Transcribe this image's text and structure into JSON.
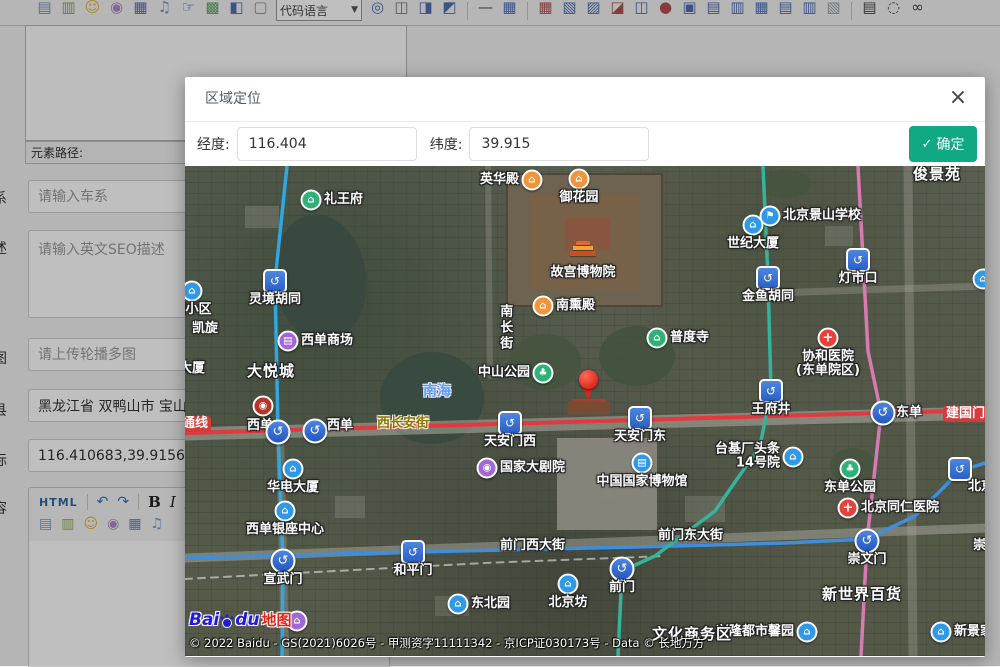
{
  "toolbar": {
    "dropdown_label": "代码语言",
    "icons": [
      {
        "name": "image-icon",
        "glyph": "▤",
        "color": "#6f94c4"
      },
      {
        "name": "multi-image-icon",
        "glyph": "▥",
        "color": "#87a35f"
      },
      {
        "name": "emoticon-icon",
        "glyph": "☺",
        "color": "#e2b437"
      },
      {
        "name": "palette-icon",
        "glyph": "◉",
        "color": "#b089c9"
      },
      {
        "name": "video-icon",
        "glyph": "▦",
        "color": "#4f6fb5"
      },
      {
        "name": "music-icon",
        "glyph": "♫",
        "color": "#6f9ad0"
      },
      {
        "name": "link-hand-icon",
        "glyph": "☞",
        "color": "#4f6fb5"
      },
      {
        "name": "map-icon",
        "glyph": "▩",
        "color": "#5fa05f"
      },
      {
        "name": "flash-icon",
        "glyph": "◧",
        "color": "#4f6fb5"
      },
      {
        "name": "page-icon",
        "glyph": "▢",
        "color": "#8a8a8a"
      },
      {
        "name": "globe-icon",
        "glyph": "◎",
        "color": "#4f6fb5"
      },
      {
        "name": "anchor-icon",
        "glyph": "◫",
        "color": "#777777"
      },
      {
        "name": "columns-icon",
        "glyph": "◨",
        "color": "#4f6fb5"
      },
      {
        "name": "layout-icon",
        "glyph": "◩",
        "color": "#4f6fb5"
      },
      {
        "name": "hr-icon",
        "glyph": "—",
        "color": "#555555"
      },
      {
        "name": "table-icon",
        "glyph": "▦",
        "color": "#4f6fb5"
      },
      {
        "name": "table-delete-icon",
        "glyph": "▦",
        "color": "#b05050"
      },
      {
        "name": "table-left-icon",
        "glyph": "▧",
        "color": "#4f6fb5"
      },
      {
        "name": "table-bottom-icon",
        "glyph": "▨",
        "color": "#4f6fb5"
      },
      {
        "name": "row-arrow-icon",
        "glyph": "◪",
        "color": "#b05050"
      },
      {
        "name": "col-insert-icon",
        "glyph": "◫",
        "color": "#4f6fb5"
      },
      {
        "name": "pin-cell-icon",
        "glyph": "●",
        "color": "#b05050"
      },
      {
        "name": "cell-block-icon",
        "glyph": "▣",
        "color": "#4f6fb5"
      },
      {
        "name": "row-insert-icon",
        "glyph": "▤",
        "color": "#4f6fb5"
      },
      {
        "name": "cell-merge-icon",
        "glyph": "▥",
        "color": "#4f6fb5"
      },
      {
        "name": "table-grid-icon",
        "glyph": "▦",
        "color": "#4f6fb5"
      },
      {
        "name": "table-rows-icon",
        "glyph": "▤",
        "color": "#4f6fb5"
      },
      {
        "name": "table-cols-icon",
        "glyph": "▥",
        "color": "#4f6fb5"
      },
      {
        "name": "chart-icon",
        "glyph": "▧",
        "color": "#9aa0a6"
      },
      {
        "name": "print-icon",
        "glyph": "▤",
        "color": "#444444"
      },
      {
        "name": "preview-icon",
        "glyph": "◌",
        "color": "#444444"
      },
      {
        "name": "binoculars-icon",
        "glyph": "∞",
        "color": "#444444"
      }
    ]
  },
  "editor_panel": {
    "path_label": "元素路径:"
  },
  "form": {
    "series_label": "系",
    "series_placeholder": "请输入车系",
    "desc_label": "述",
    "desc_placeholder": "请输入英文SEO描述",
    "image_label": "图",
    "image_placeholder": "请上传轮播多图",
    "county_label": "县",
    "county_value": "黑龙江省 双鸭山市 宝山区",
    "coord_label": "标",
    "coord_value": "116.410683,39.915637",
    "content_label": "容"
  },
  "content_editor": {
    "html_label": "HTML",
    "undo": "↶",
    "redo": "↷",
    "bold": "B",
    "italic": "I",
    "underline": "U",
    "icons": [
      {
        "name": "image-icon",
        "glyph": "▤",
        "color": "#7a9cc6"
      },
      {
        "name": "multi-image-icon",
        "glyph": "▥",
        "color": "#8aab5a"
      },
      {
        "name": "emoticon-icon",
        "glyph": "☺",
        "color": "#e2b437"
      },
      {
        "name": "palette-icon",
        "glyph": "◉",
        "color": "#b089c9"
      },
      {
        "name": "video-icon",
        "glyph": "▦",
        "color": "#5b7fb9"
      },
      {
        "name": "music-icon",
        "glyph": "♫",
        "color": "#6f9ad0"
      }
    ]
  },
  "modal": {
    "title": "区域定位",
    "close_glyph": "×",
    "lng_label": "经度:",
    "lng_value": "116.404",
    "lat_label": "纬度:",
    "lat_value": "39.915",
    "confirm_check": "✓",
    "confirm_label": "确定",
    "confirm_color": "#11a983"
  },
  "map": {
    "attribution": "© 2022 Baidu - GS(2021)6026号 - 甲测资字11111342 - 京ICP证030173号 - Data © 长地万方",
    "logo": {
      "bai": "Bai",
      "du": "du",
      "suffix": "地图"
    },
    "lines": [
      {
        "name": "changan-avenue-road",
        "color": "#b7b6ac",
        "width": 13,
        "opacity": 0.5,
        "points": "0,268 800,247"
      },
      {
        "name": "qianmen-street-road",
        "color": "#b2b1a7",
        "width": 9,
        "opacity": 0.45,
        "points": "0,392 800,362"
      },
      {
        "name": "dongdan-north-road",
        "color": "#b2b1a7",
        "width": 9,
        "opacity": 0.3,
        "points": "723,0 728,490"
      },
      {
        "name": "dengshikou-road",
        "color": "#b2b1a7",
        "width": 7,
        "opacity": 0.3,
        "points": "560,128 800,120"
      },
      {
        "name": "nanchang-street-road",
        "color": "#b2b1a7",
        "width": 6,
        "opacity": 0.25,
        "points": "303,0 305,210"
      },
      {
        "name": "xuanwumen-road",
        "color": "#b2b1a7",
        "width": 8,
        "opacity": 0.3,
        "points": "95,265 100,490"
      },
      {
        "name": "railway-dashed",
        "color": "rgba(255,255,255,0.5)",
        "width": 2,
        "dash": "7 6",
        "points": "0,413 300,397 480,390"
      },
      {
        "name": "subway-line-2",
        "color": "#3f8edb",
        "width": 3.5,
        "points": "0,392 230,386 450,381 600,377 682,373 730,350 775,305 800,297"
      },
      {
        "name": "subway-line-1",
        "color": "#e2383f",
        "width": 4,
        "points": "0,267 800,244"
      },
      {
        "name": "subway-line-4",
        "color": "#2fa8e1",
        "width": 3.5,
        "points": "102,0 90,115 93,266 98,395 97,490"
      },
      {
        "name": "subway-line-8",
        "color": "#37b29b",
        "width": 3.5,
        "points": "578,0 583,112 586,225 575,280 530,345 470,390 437,405 433,490"
      },
      {
        "name": "subway-line-5",
        "color": "#d77ab4",
        "width": 3.5,
        "points": "673,0 683,185 696,247 682,375 676,490"
      }
    ],
    "markers": [
      {
        "t": "poi",
        "c": "green",
        "g": "⌂",
        "x": 126,
        "y": 34,
        "label": "礼王府",
        "lpos": "r"
      },
      {
        "t": "poi",
        "c": "blue",
        "g": "⌂",
        "x": 7,
        "y": 125,
        "label": "园小区",
        "lpos": "b"
      },
      {
        "t": "metro",
        "x": 90,
        "y": 115,
        "label": "灵境胡同",
        "lpos": "b"
      },
      {
        "t": "label",
        "cls": "poi-lbl",
        "x": 7,
        "y": 163,
        "label": "凯旋"
      },
      {
        "t": "poi",
        "c": "orange",
        "g": "⌂",
        "x": 347,
        "y": 14,
        "label": "英华殿",
        "lpos": "l"
      },
      {
        "t": "poi",
        "c": "orange",
        "g": "⌂",
        "x": 394,
        "y": 13,
        "label": "御花园",
        "lpos": "b"
      },
      {
        "t": "palace",
        "x": 398,
        "y": 88,
        "label": "故宫博物院",
        "lpos": "b"
      },
      {
        "t": "poi",
        "c": "orange",
        "g": "⌂",
        "x": 358,
        "y": 140,
        "label": "南熏殿",
        "lpos": "r"
      },
      {
        "t": "label",
        "cls": "vert",
        "x": 320,
        "y": 138,
        "label": "南长街"
      },
      {
        "t": "label",
        "cls": "big",
        "x": 728,
        "y": 8,
        "label": "俊景苑"
      },
      {
        "t": "poi",
        "c": "blue",
        "g": "⚑",
        "x": 585,
        "y": 50,
        "label": "北京景山学校",
        "lpos": "r"
      },
      {
        "t": "poi",
        "c": "blue",
        "g": "⌂",
        "x": 568,
        "y": 59,
        "label": "世纪大厦",
        "lpos": "b"
      },
      {
        "t": "metro",
        "x": 673,
        "y": 94,
        "label": "灯市口",
        "lpos": "b"
      },
      {
        "t": "metro",
        "x": 583,
        "y": 112,
        "label": "金鱼胡同",
        "lpos": "b"
      },
      {
        "t": "poi",
        "c": "blue",
        "g": "⌂",
        "x": 798,
        "y": 113
      },
      {
        "t": "hospital",
        "x": 643,
        "y": 172,
        "label": "协和医院\n(东单院区)",
        "lpos": "b"
      },
      {
        "t": "metro",
        "x": 586,
        "y": 225,
        "label": "王府井",
        "lpos": "b"
      },
      {
        "t": "metrox",
        "x": 698,
        "y": 247,
        "label": "东单",
        "lpos": "r"
      },
      {
        "t": "label",
        "cls": "road-red",
        "x": 758,
        "y": 248,
        "label": "建国门内"
      },
      {
        "t": "poi",
        "c": "blue",
        "g": "⌂",
        "x": 608,
        "y": 291,
        "label": "台基厂头条\n14号院",
        "lpos": "l"
      },
      {
        "t": "poi",
        "c": "green",
        "g": "♣",
        "x": 665,
        "y": 303,
        "label": "东单公园",
        "lpos": "b"
      },
      {
        "t": "hospital",
        "x": 663,
        "y": 342,
        "label": "北京同仁医院",
        "lpos": "r"
      },
      {
        "t": "metrox",
        "x": 682,
        "y": 375,
        "label": "崇文门",
        "lpos": "b"
      },
      {
        "t": "metro",
        "x": 775,
        "y": 303,
        "label": "北京站",
        "lpos": "br"
      },
      {
        "t": "label",
        "cls": "big",
        "x": 637,
        "y": 428,
        "label": "新世界百货"
      },
      {
        "t": "poi",
        "c": "blue",
        "g": "⌂",
        "x": 622,
        "y": 466,
        "label": "兴隆都市馨园",
        "lpos": "l"
      },
      {
        "t": "poi",
        "c": "blue",
        "g": "⌂",
        "x": 756,
        "y": 466,
        "label": "新景家园",
        "lpos": "r"
      },
      {
        "t": "label",
        "cls": "road-white",
        "x": 788,
        "y": 380,
        "label": "崇文"
      },
      {
        "t": "poi",
        "c": "purple",
        "g": "▤",
        "x": 103,
        "y": 175,
        "label": "西单商场",
        "lpos": "r"
      },
      {
        "t": "label",
        "cls": "big",
        "x": 62,
        "y": 205,
        "label": "大悦城"
      },
      {
        "t": "label",
        "cls": "poi-lbl",
        "x": 62,
        "y": 260,
        "label": "西单"
      },
      {
        "t": "metrox",
        "x": 93,
        "y": 266
      },
      {
        "t": "metrox",
        "x": 130,
        "y": 265
      },
      {
        "t": "label",
        "cls": "poi-lbl",
        "x": 142,
        "y": 260,
        "label": "西单"
      },
      {
        "t": "label",
        "cls": "road-yellow",
        "x": 192,
        "y": 258,
        "label": "西长安街"
      },
      {
        "t": "label",
        "cls": "water-lbl",
        "x": 238,
        "y": 226,
        "label": "南海"
      },
      {
        "t": "label",
        "cls": "road-red",
        "x": -6,
        "y": 258,
        "label": "通线"
      },
      {
        "t": "label",
        "cls": "poi-lbl",
        "x": -6,
        "y": 203,
        "label": "大厦"
      },
      {
        "t": "poi",
        "c": "darkred",
        "g": "◉",
        "x": 78,
        "y": 240
      },
      {
        "t": "poi",
        "c": "blue",
        "g": "⌂",
        "x": 108,
        "y": 303,
        "label": "华电大厦",
        "lpos": "b"
      },
      {
        "t": "poi",
        "c": "green",
        "g": "♣",
        "x": 358,
        "y": 207,
        "label": "中山公园",
        "lpos": "l"
      },
      {
        "t": "poi",
        "c": "green",
        "g": "⌂",
        "x": 472,
        "y": 172,
        "label": "普度寺",
        "lpos": "r"
      },
      {
        "t": "pin",
        "x": 403,
        "y": 237
      },
      {
        "t": "metro",
        "x": 325,
        "y": 257,
        "label": "天安门西",
        "lpos": "b"
      },
      {
        "t": "metro",
        "x": 455,
        "y": 252,
        "label": "天安门东",
        "lpos": "b"
      },
      {
        "t": "poi",
        "c": "purple",
        "g": "◉",
        "x": 302,
        "y": 302,
        "label": "国家大剧院",
        "lpos": "r"
      },
      {
        "t": "poi",
        "c": "blue",
        "g": "▤",
        "x": 457,
        "y": 297,
        "label": "中国国家博物馆",
        "lpos": "b"
      },
      {
        "t": "poi",
        "c": "blue",
        "g": "⌂",
        "x": 100,
        "y": 345,
        "label": "西单银座中心",
        "lpos": "b"
      },
      {
        "t": "metrox",
        "x": 98,
        "y": 395,
        "label": "宣武门",
        "lpos": "b"
      },
      {
        "t": "metro",
        "x": 228,
        "y": 386,
        "label": "和平门",
        "lpos": "b"
      },
      {
        "t": "label",
        "cls": "road-white",
        "x": 315,
        "y": 380,
        "label": "前门西大街"
      },
      {
        "t": "label",
        "cls": "road-white",
        "x": 473,
        "y": 370,
        "label": "前门东大街"
      },
      {
        "t": "metrox",
        "x": 437,
        "y": 403,
        "label": "前门",
        "lpos": "b"
      },
      {
        "t": "poi",
        "c": "blue",
        "g": "⌂",
        "x": 383,
        "y": 418,
        "label": "北京坊",
        "lpos": "b"
      },
      {
        "t": "poi",
        "c": "blue",
        "g": "⌂",
        "x": 273,
        "y": 438,
        "label": "东北园",
        "lpos": "r"
      },
      {
        "t": "label",
        "cls": "big",
        "x": 467,
        "y": 468,
        "label": "文化商务区"
      },
      {
        "t": "poi",
        "c": "purple",
        "g": "⌂",
        "x": 112,
        "y": 455
      }
    ]
  }
}
